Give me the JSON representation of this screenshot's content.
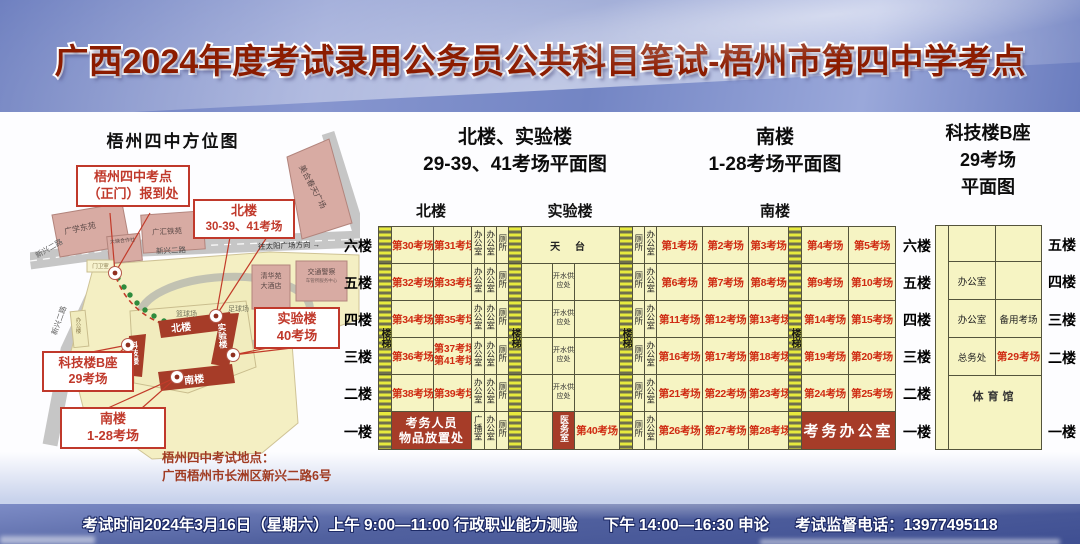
{
  "header": {
    "title": "广西2024年度考试录用公务员公共科目笔试-梧州市第四中学考点"
  },
  "map": {
    "title": "梧州四中方位图",
    "callout_gate_1": "梧州四中考点",
    "callout_gate_2": "（正门）报到处",
    "callout_north_1": "北楼",
    "callout_north_2": "30-39、41考场",
    "callout_lab_1": "实验楼",
    "callout_lab_2": "40考场",
    "callout_tech_1": "科技楼B座",
    "callout_tech_2": "29考场",
    "callout_south_1": "南楼",
    "callout_south_2": "1-28考场",
    "address_title": "梧州四中考试地点：",
    "address": "广西梧州市长洲区新兴二路6号",
    "road_xinxing": "新兴二路",
    "road_xinxing_2": "新兴二路",
    "road_direction": "往太阳广场方向 →",
    "place_guangxue": "广学东苑",
    "place_datang": "大塘合作社",
    "place_guanghui": "广汇铁苑",
    "place_meihe": "美合春天广场",
    "place_qinghua_1": "清华苑",
    "place_qinghua_2": "大酒店",
    "place_police": "交通警察",
    "place_police_sub": "车管所服务中心",
    "gatehouse": "门卫室",
    "office_building": "办公楼",
    "basketball": "篮球场",
    "football": "足球场",
    "b_north": "北楼",
    "b_lab": "实验楼",
    "b_tech": "科技楼",
    "b_south": "南楼"
  },
  "plans": {
    "left_title_1": "北楼、实验楼",
    "left_title_2": "29-39、41考场平面图",
    "mid_title_1": "南楼",
    "mid_title_2": "1-28考场平面图",
    "right_title_1": "科技楼B座",
    "right_title_2": "29考场",
    "right_title_3": "平面图",
    "sec_north": "北楼",
    "sec_lab": "实验楼",
    "sec_south": "南楼",
    "floors": [
      "六楼",
      "五楼",
      "四楼",
      "三楼",
      "二楼",
      "一楼"
    ],
    "tech_floors": [
      "五楼",
      "四楼",
      "三楼",
      "二楼",
      "一楼"
    ],
    "office": "办公室",
    "toilet": "厕所",
    "stairs": "楼梯",
    "broadcast": "广播室",
    "water": "开水供应处",
    "rooftop": "天  台",
    "medical": "医务室",
    "deposit_1": "考务人员",
    "deposit_2": "物品放置处",
    "exam_office": "考务办公室",
    "backup": "备用考场",
    "affairs": "总务处",
    "gym": "体育馆",
    "room40": "第40考场",
    "room29": "第29考场",
    "north_rooms": [
      [
        "第30考场",
        "第31考场"
      ],
      [
        "第32考场",
        "第33考场"
      ],
      [
        "第34考场",
        "第35考场"
      ],
      [
        "第36考场",
        "第37考场",
        "第41考场"
      ],
      [
        "第38考场",
        "第39考场"
      ]
    ],
    "south_rooms": [
      [
        "第1考场",
        "第2考场",
        "第3考场",
        "第4考场",
        "第5考场"
      ],
      [
        "第6考场",
        "第7考场",
        "第8考场",
        "第9考场",
        "第10考场"
      ],
      [
        "第11考场",
        "第12考场",
        "第13考场",
        "第14考场",
        "第15考场"
      ],
      [
        "第16考场",
        "第17考场",
        "第18考场",
        "第19考场",
        "第20考场"
      ],
      [
        "第21考场",
        "第22考场",
        "第23考场",
        "第24考场",
        "第25考场"
      ],
      [
        "第26考场",
        "第27考场",
        "第28考场"
      ]
    ]
  },
  "footer": {
    "seg_1": "考试时间2024年3月16日（星期六）上午 9:00—11:00 行政职业能力测验",
    "seg_2": "下午 14:00—16:30 申论",
    "seg_3": "考试监督电话：13977495118"
  },
  "colors": {
    "accent_red": "#a63c28",
    "room_red": "#cf2b12",
    "header_blue": "#7c8cc8",
    "cell_yellow": "#f6f4c3"
  }
}
